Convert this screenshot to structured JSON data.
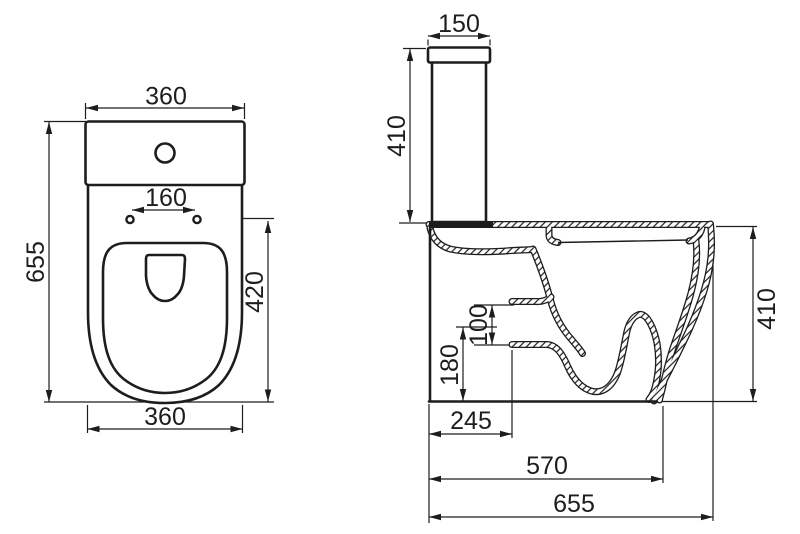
{
  "colors": {
    "line": "#1d1d1b",
    "background": "#ffffff"
  },
  "top_view": {
    "tank_width": "360",
    "bolt_hole_spacing": "160",
    "overall_length": "655",
    "bowl_length": "420",
    "base_width": "360"
  },
  "side_view": {
    "lid_depth": "150",
    "tank_height": "410",
    "inlet_opening": "100",
    "inlet_center_height": "180",
    "inlet_setback": "245",
    "foot_depth": "570",
    "overall_depth": "655",
    "bowl_height": "410"
  }
}
